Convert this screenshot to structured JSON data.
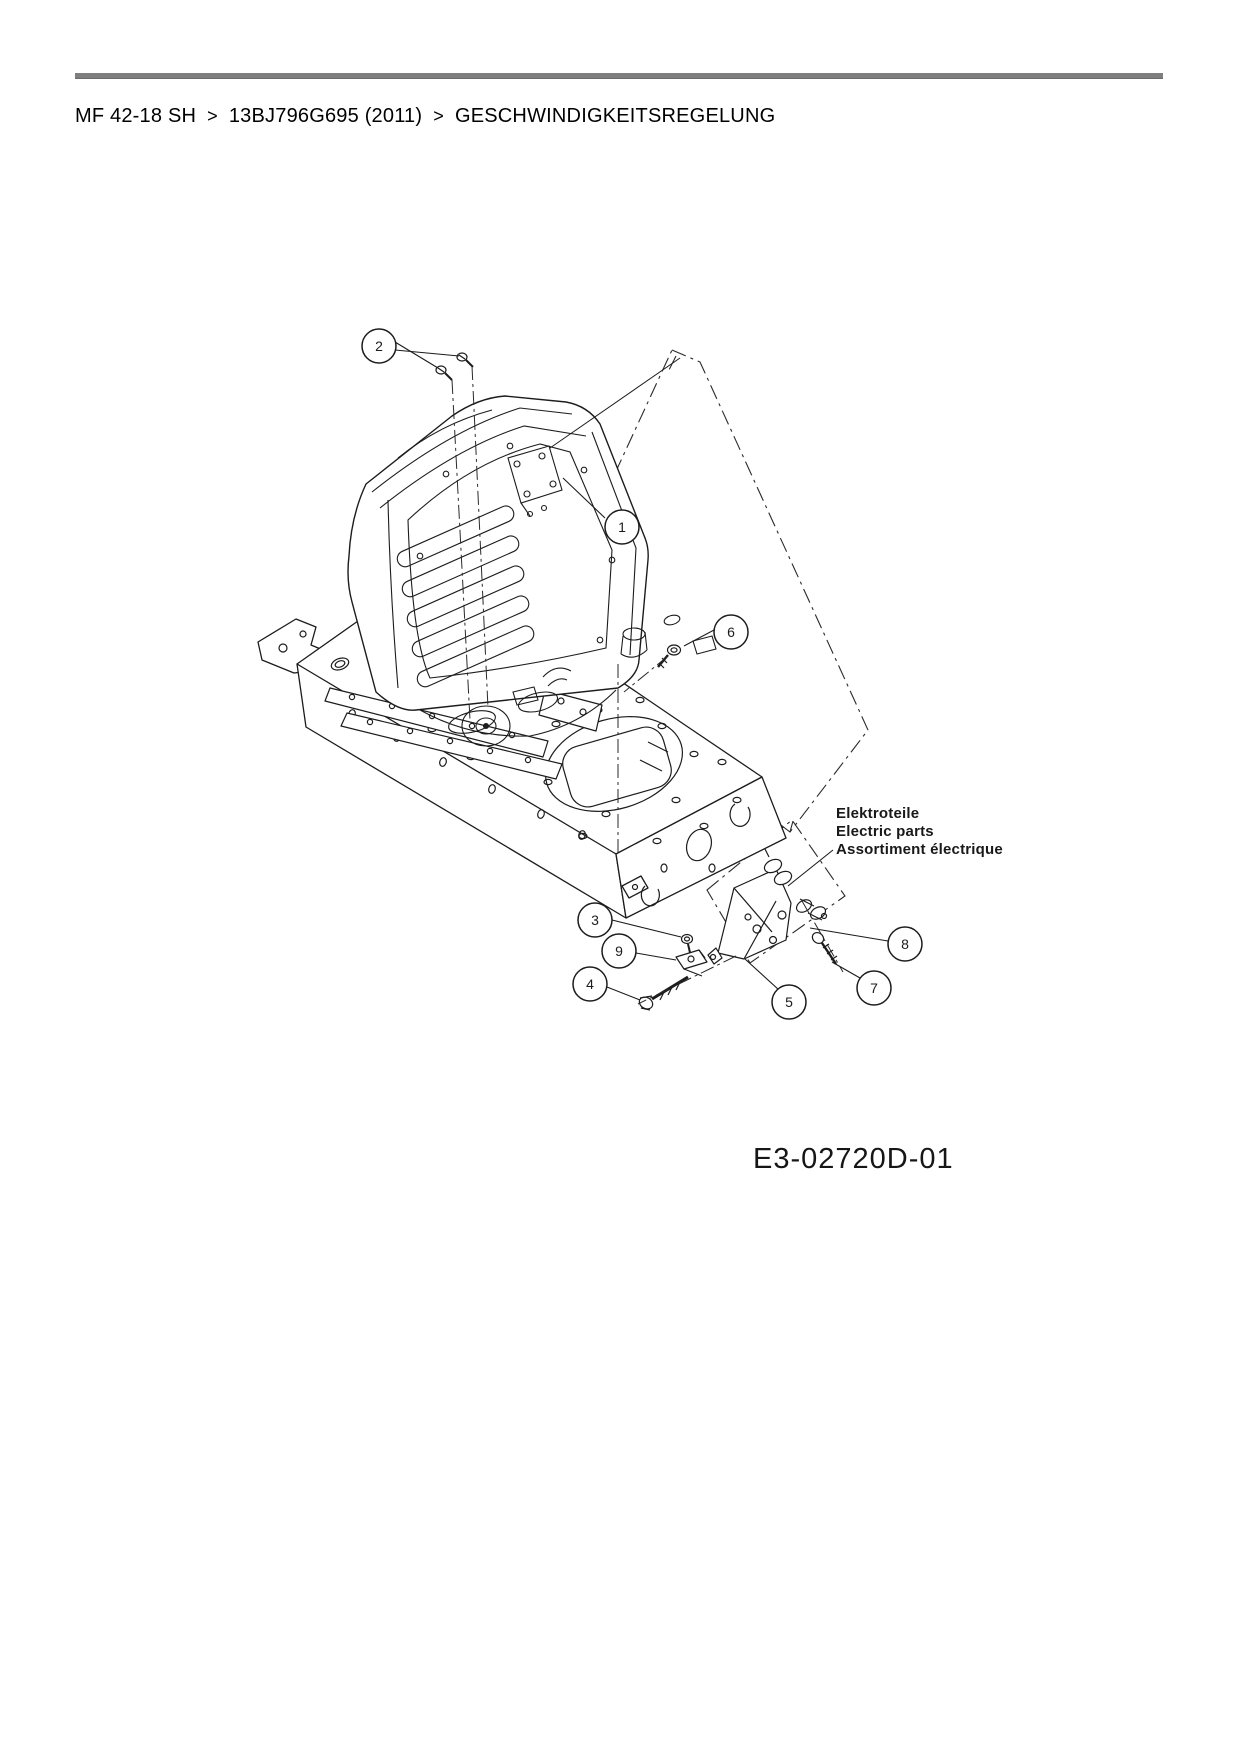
{
  "page": {
    "background": "#ffffff",
    "rule_color": "#7f7f7f"
  },
  "breadcrumb": {
    "separator": ">",
    "items": [
      "MF 42-18 SH",
      "13BJ796G695 (2011)",
      "GESCHWINDIGKEITSREGELUNG"
    ]
  },
  "diagram": {
    "title_implicit": "exploded parts diagram - seat and frame / speed control",
    "line_color": "#1c1c1c",
    "callouts": [
      {
        "label": "1"
      },
      {
        "label": "2"
      },
      {
        "label": "3"
      },
      {
        "label": "4"
      },
      {
        "label": "5"
      },
      {
        "label": "6"
      },
      {
        "label": "7"
      },
      {
        "label": "8"
      },
      {
        "label": "9"
      }
    ],
    "part_group_label": {
      "lines": [
        "Elektroteile",
        "Electric parts",
        "Assortiment électrique"
      ]
    },
    "drawing_code": "E3-02720D-01"
  }
}
